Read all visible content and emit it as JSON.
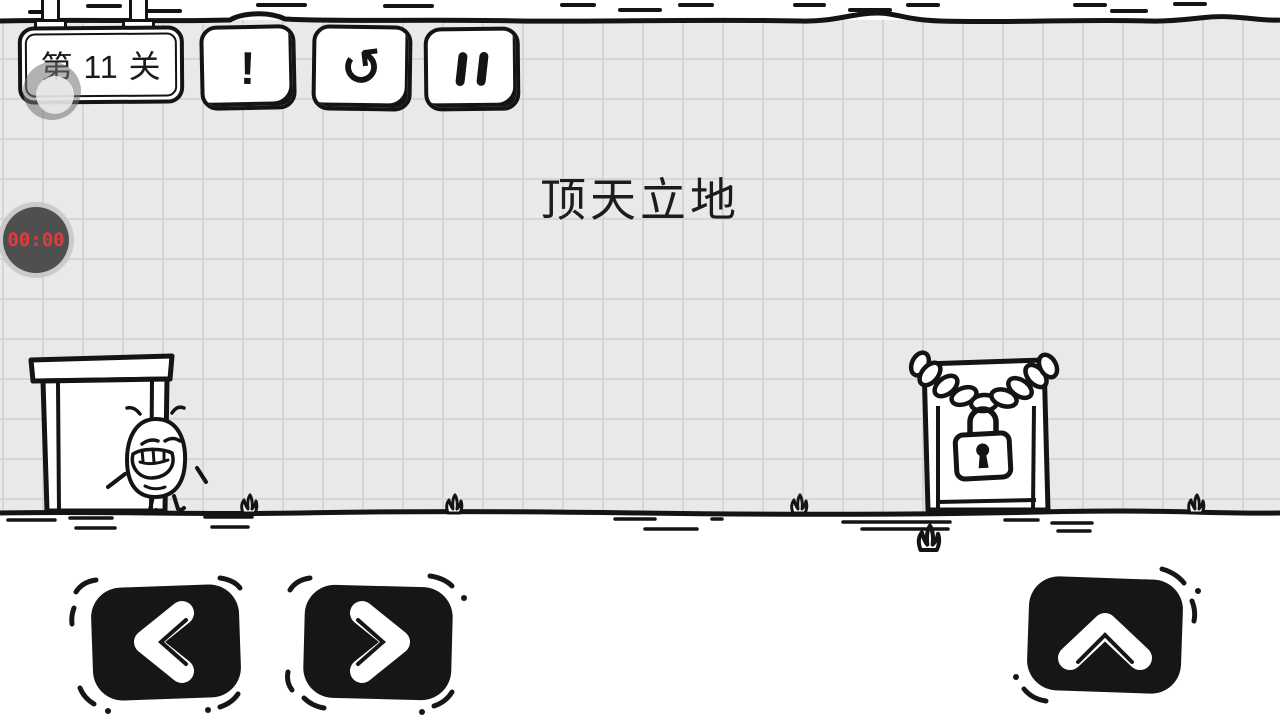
{
  "hud": {
    "level_label": "第 11 关",
    "timer_value": "00:00",
    "hint_glyph": "!",
    "restart_glyph": "↺"
  },
  "level": {
    "title": "顶天立地"
  },
  "icons": {
    "hint": "exclamation-icon",
    "restart": "restart-arrow-icon",
    "pause": "pause-bars-icon",
    "move_left": "chevron-left-icon",
    "move_right": "chevron-right-icon",
    "jump": "chevron-up-icon",
    "lock": "padlock-icon",
    "chain": "chain-icon"
  },
  "colors": {
    "ink": "#141414",
    "paper": "#ffffff",
    "grid_bg": "#e9e9e9",
    "grid_line": "#d6d6d6",
    "button_fill": "#161616",
    "timer_text": "#e23b3b",
    "timer_face": "#4b4b4b"
  }
}
